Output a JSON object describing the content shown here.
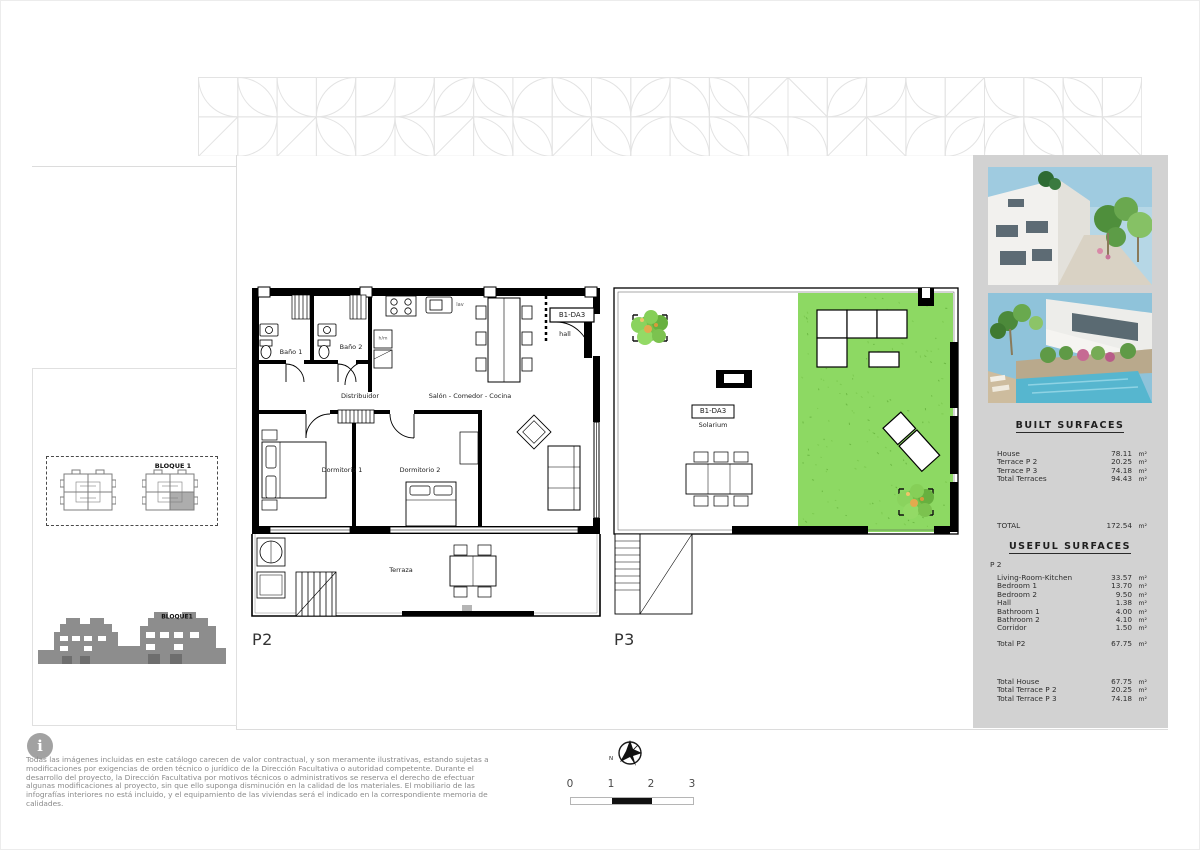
{
  "plans": {
    "p2": {
      "label": "P2",
      "unit_code": "B1-DA3",
      "rooms": {
        "bano1": "Baño 1",
        "bano2": "Baño 2",
        "distribuidor": "Distribuidor",
        "salon": "Salón - Comedor - Cocina",
        "dormitorio1": "Dormitorio 1",
        "dormitorio2": "Dormitorio 2",
        "hall": "hall",
        "terraza": "Terraza",
        "lav": "lav",
        "washer": "h/m"
      }
    },
    "p3": {
      "label": "P3",
      "unit_code": "B1-DA3",
      "rooms": {
        "solarium": "Solarium"
      }
    }
  },
  "site_key": {
    "block_plan_label": "BLOQUE 1",
    "block_elevation_label": "BLOQUE1"
  },
  "sidebar": {
    "built_surfaces": {
      "title": "BUILT SURFACES",
      "rows": [
        {
          "label": "House",
          "value": "78.11",
          "unit": "m²"
        },
        {
          "label": "Terrace  P 2",
          "value": "20.25",
          "unit": "m²"
        },
        {
          "label": "Terrace  P 3",
          "value": "74.18",
          "unit": "m²"
        },
        {
          "label": "Total Terraces",
          "value": "94.43",
          "unit": "m²"
        }
      ],
      "total": {
        "label": "TOTAL",
        "value": "172.54",
        "unit": "m²"
      }
    },
    "useful_surfaces": {
      "title": "USEFUL SURFACES",
      "section_label": "P 2",
      "rows": [
        {
          "label": "Living-Room-Kitchen",
          "value": "33.57",
          "unit": "m²"
        },
        {
          "label": "Bedroom 1",
          "value": "13.70",
          "unit": "m²"
        },
        {
          "label": "Bedroom 2",
          "value": "9.50",
          "unit": "m²"
        },
        {
          "label": "Hall",
          "value": "1.38",
          "unit": "m²"
        },
        {
          "label": "Bathroom 1",
          "value": "4.00",
          "unit": "m²"
        },
        {
          "label": "Bathroom 2",
          "value": "4.10",
          "unit": "m²"
        },
        {
          "label": "Corridor",
          "value": "1.50",
          "unit": "m²"
        }
      ],
      "subtotal": {
        "label": "Total  P2",
        "value": "67.75",
        "unit": "m²"
      },
      "totals": [
        {
          "label": "Total  House",
          "value": "67.75",
          "unit": "m²"
        },
        {
          "label": "Total  Terrace  P 2",
          "value": "20.25",
          "unit": "m²"
        },
        {
          "label": "Total  Terrace  P 3",
          "value": "74.18",
          "unit": "m²"
        }
      ]
    }
  },
  "footer": {
    "disclaimer": "Todas las imágenes incluidas en este catálogo carecen de valor contractual, y son meramente ilustrativas, estando sujetas a modificaciones por exigencias de orden técnico o jurídico de la Dirección Facultativa o autoridad competente. Durante el desarrollo del proyecto, la Dirección Facultativa por motivos técnicos o administrativos se reserva el derecho de efectuar algunas modificaciones al proyecto, sin que ello suponga disminución en la calidad de los materiales. El mobiliario de las infografías interiores no está incluido, y el equipamiento de las viviendas será el indicado en la correspondiente memoria de calidades.",
    "north_label": "N",
    "scale_ticks": [
      "0",
      "1",
      "2",
      "3"
    ]
  },
  "colors": {
    "grass_green": "#8dd963",
    "sidebar_gray": "#d2d2d2",
    "wall_black": "#000000",
    "pattern_gray": "#e3e3e3",
    "muted_text": "#8a8a8a"
  }
}
